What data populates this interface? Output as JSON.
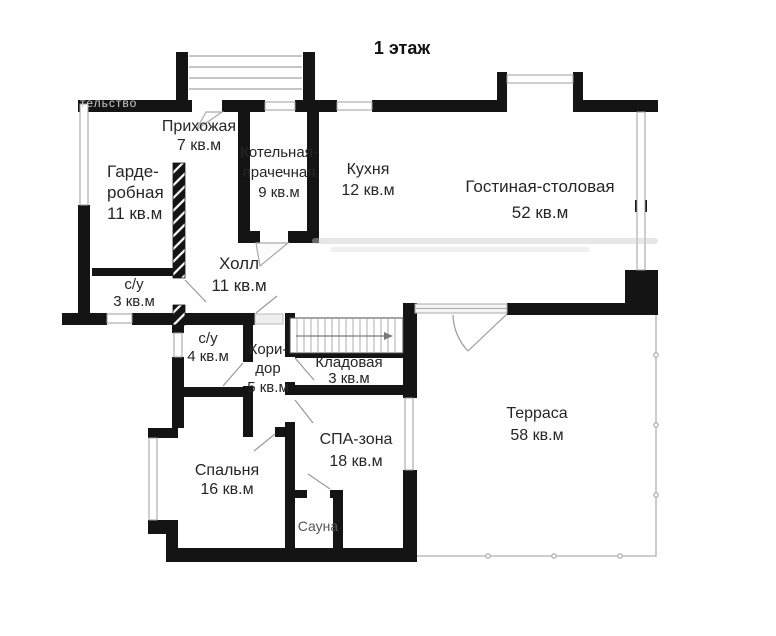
{
  "title": "1 этаж",
  "watermark_text": "тельство",
  "rooms": {
    "prihozhaya": {
      "name": "Прихожая",
      "area": "7 кв.м"
    },
    "garderobnaya": {
      "line1": "Гарде-",
      "line2": "робная",
      "area": "11 кв.м"
    },
    "su3": {
      "name": "с/у",
      "area": "3 кв.м"
    },
    "kotelnaya": {
      "line1": "Котельная-",
      "line2": "прачечная",
      "area": "9 кв.м"
    },
    "kuhnya": {
      "name": "Кухня",
      "area": "12 кв.м"
    },
    "gostinaya": {
      "name": "Гостиная-столовая",
      "area": "52 кв.м"
    },
    "holl": {
      "name": "Холл",
      "area": "11 кв.м"
    },
    "su4": {
      "name": "с/у",
      "area": "4 кв.м"
    },
    "koridor": {
      "line1": "Кори-",
      "line2": "дор",
      "area": "5 кв.м"
    },
    "kladovaya": {
      "name": "Кладовая",
      "area": "3 кв.м"
    },
    "spa": {
      "name": "СПА-зона",
      "area": "18 кв.м"
    },
    "spalnya": {
      "name": "Спальня",
      "area": "16 кв.м"
    },
    "sauna": {
      "name": "Сауна"
    },
    "terrasa": {
      "name": "Терраса",
      "area": "58 кв.м"
    }
  },
  "colors": {
    "wall": "#141414",
    "window_line": "#9e9e9e",
    "door_line": "#999999",
    "terrace_line": "#b0b0b0",
    "text": "#262626",
    "sauna_text": "#555555",
    "watermark": "#c9c9c9",
    "background": "#ffffff"
  }
}
